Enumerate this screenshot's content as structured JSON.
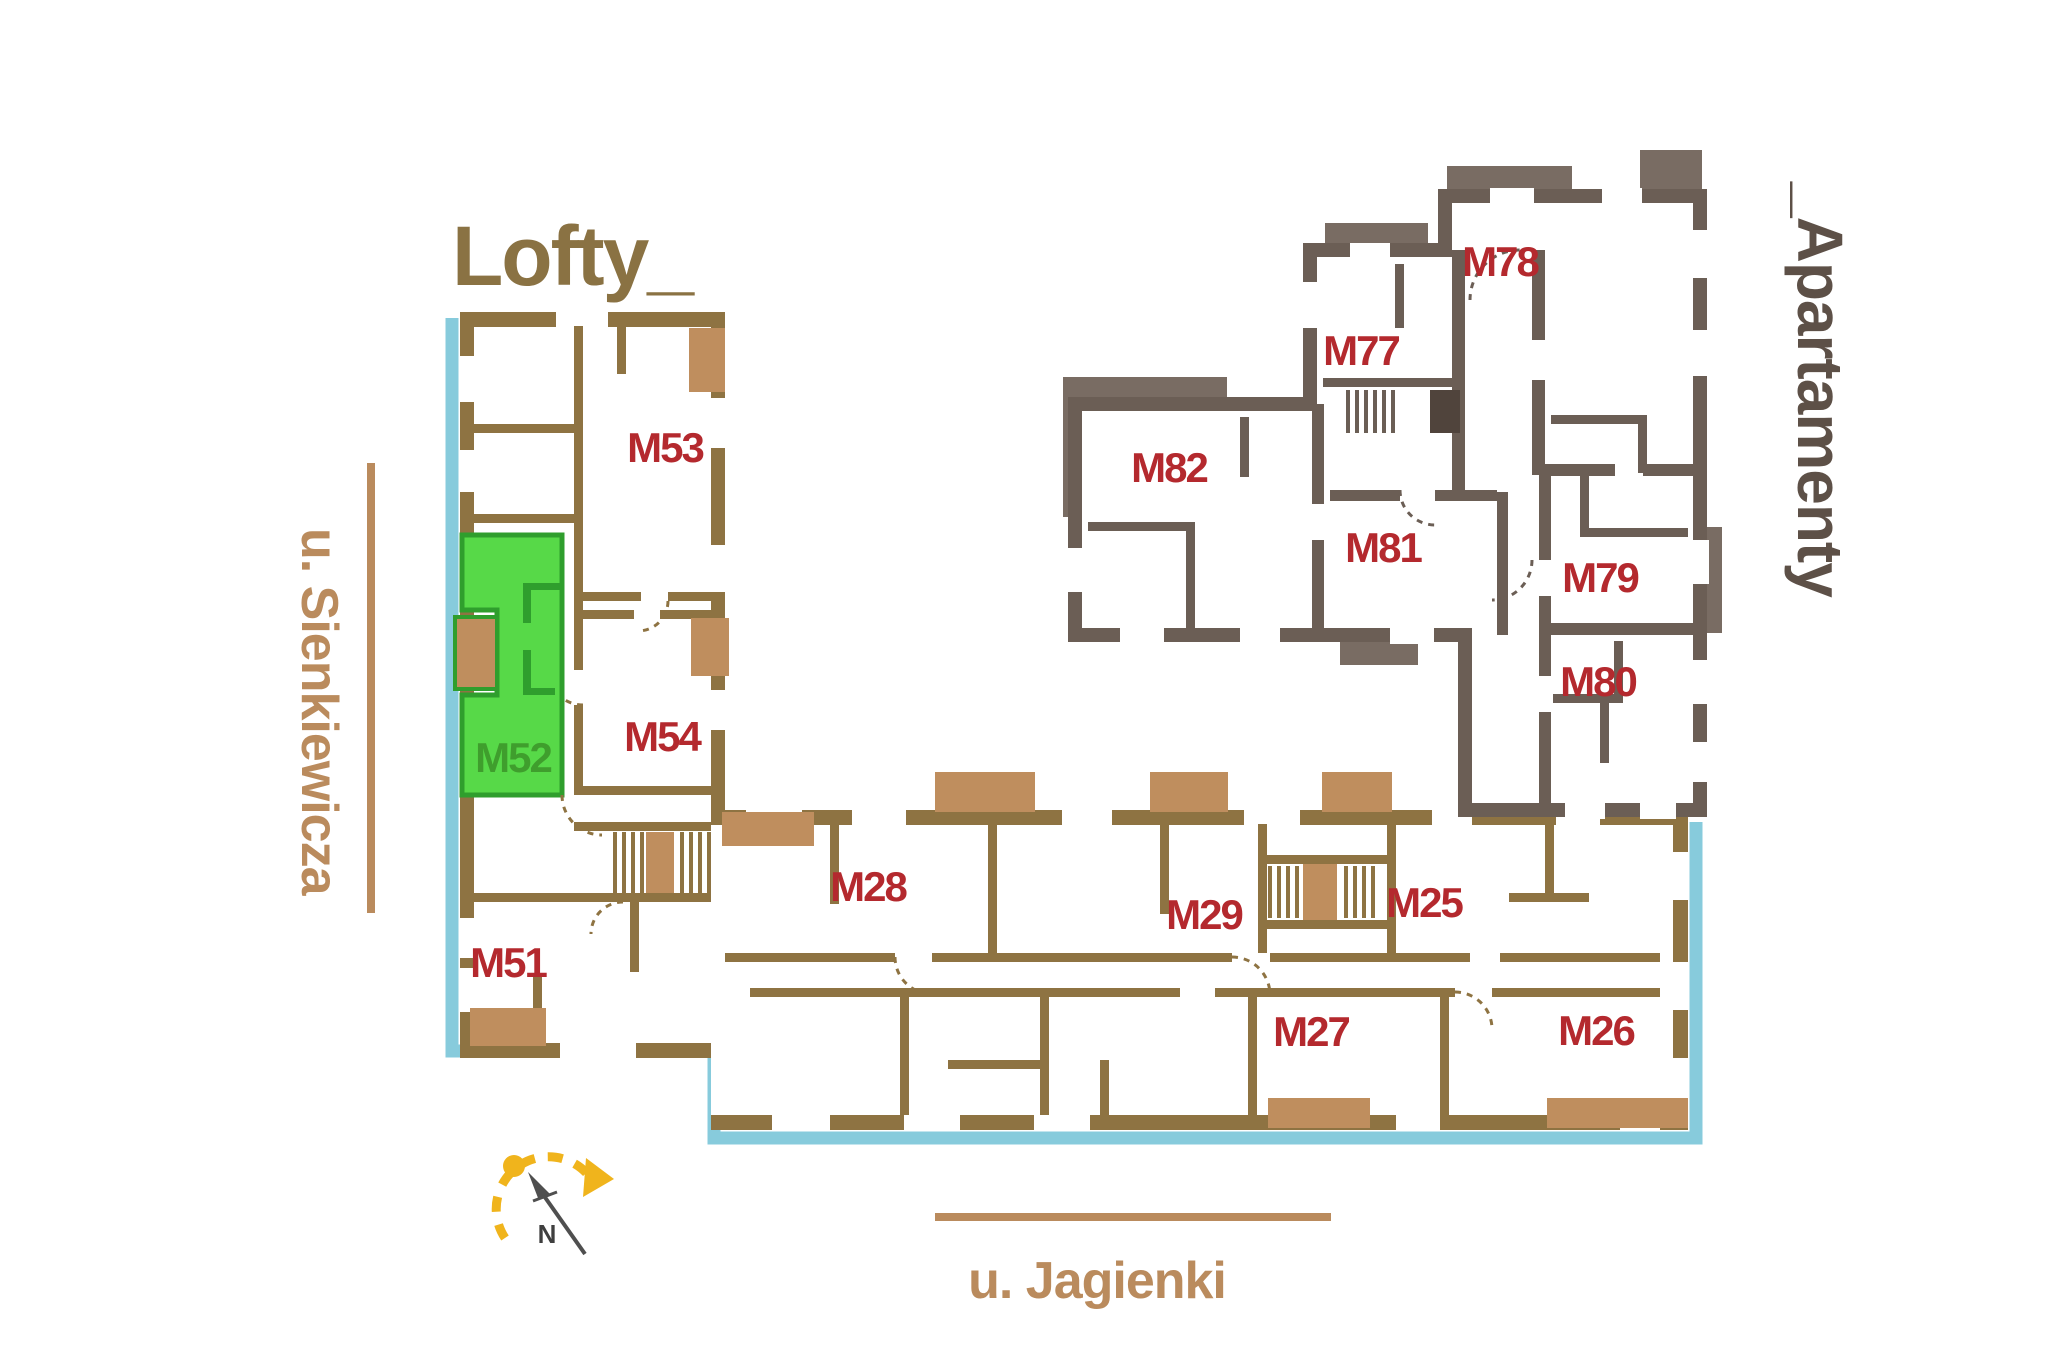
{
  "title": {
    "text": "Lofty_"
  },
  "right_label": {
    "text": "_Apartamenty"
  },
  "streets": {
    "left": "u. Sienkiewicza",
    "bottom": "u. Jagienki"
  },
  "compass": {
    "north": "N"
  },
  "highlight": {
    "unit": "M52"
  },
  "apartments": {
    "m51": "M51",
    "m52": "M52",
    "m53": "M53",
    "m54": "M54",
    "m25": "M25",
    "m26": "M26",
    "m27": "M27",
    "m28": "M28",
    "m29": "M29",
    "m77": "M77",
    "m78": "M78",
    "m79": "M79",
    "m80": "M80",
    "m81": "M81",
    "m82": "M82"
  },
  "colors": {
    "lofty_walls": "#8e7342",
    "apartamenty_walls": "#6b5e55",
    "apartamenty_balcony": "#796c63",
    "balcony_tan": "#bf8e5e",
    "unit_label_red": "#b4292e",
    "highlight_fill": "#57d948",
    "highlight_border": "#2f9e2d",
    "highlight_label": "#3f9e2d",
    "street_outline_blue": "#87cbdc",
    "street_text_tan": "#ba8b5d",
    "title_gold": "#8a7243",
    "side_label_taupe": "#5d5047",
    "compass_yellow": "#f0b41c",
    "compass_needle": "#4f4f4f"
  }
}
